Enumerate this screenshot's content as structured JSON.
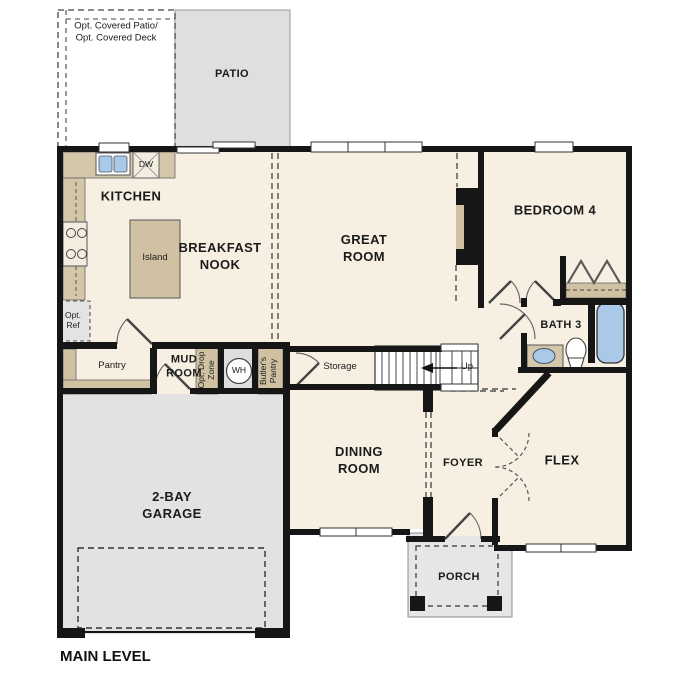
{
  "plan_title": "MAIN LEVEL",
  "labels": {
    "opt_covered_area": "Opt. Covered Patio/\nOpt. Covered Deck",
    "patio": "PATIO",
    "kitchen": "KITCHEN",
    "dw": "DW",
    "island": "Island",
    "breakfast_nook": "BREAKFAST\nNOOK",
    "great_room": "GREAT\nROOM",
    "bedroom_4": "BEDROOM 4",
    "opt_ref": "Opt.\nRef",
    "pantry": "Pantry",
    "mud_room": "MUD\nROOM",
    "opt_drop_zone": "Opt. Drop\nZone",
    "wh": "WH",
    "butlers_pantry": "Butler's\nPantry",
    "storage": "Storage",
    "up": "Up",
    "bath_3": "BATH 3",
    "dining_room": "DINING\nROOM",
    "foyer": "FOYER",
    "flex": "FLEX",
    "garage": "2-BAY\nGARAGE",
    "porch": "PORCH"
  },
  "colors": {
    "floor": "#f7f0e2",
    "wall": "#161616",
    "counter_tan": "#d3c6a9",
    "garage_gray": "#e2e2e2",
    "patio_gray": "#dfdfdf",
    "fixture_blue": "#aac9e8"
  }
}
